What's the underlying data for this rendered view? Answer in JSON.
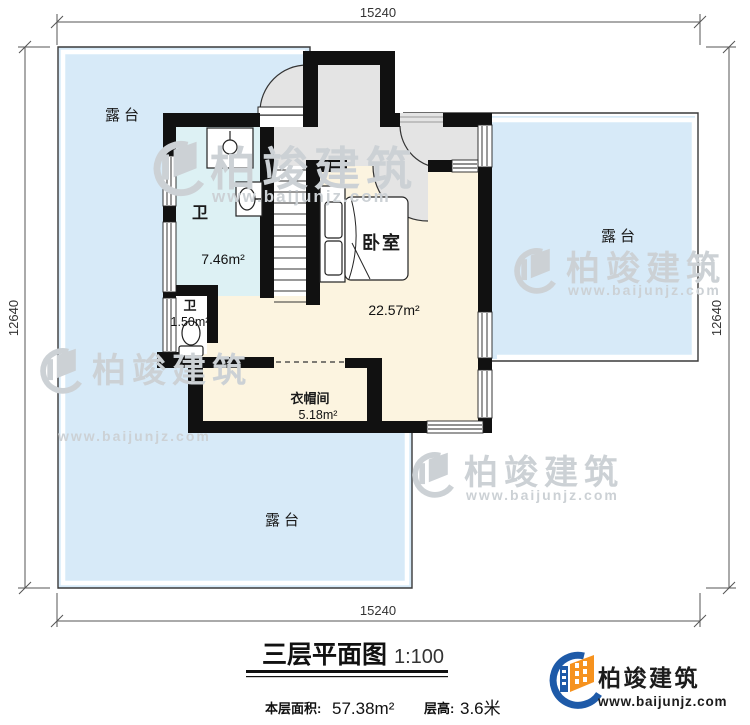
{
  "plan": {
    "dim_top": "15240",
    "dim_bottom": "15240",
    "dim_left": "12640",
    "dim_right": "12640",
    "rooms": {
      "terrace_top": "露台",
      "terrace_right": "露台",
      "terrace_bottom": "露台",
      "bathroom_label": "卫",
      "bathroom_area": "7.46m²",
      "wc_label": "卫",
      "wc_area": "1.50m²",
      "bedroom_label": "卧室",
      "bedroom_area": "22.57m²",
      "cloakroom_label": "衣帽间",
      "cloakroom_area": "5.18m²"
    }
  },
  "title_block": {
    "title": "三层平面图",
    "scale": "1:100",
    "area_label": "本层面积:",
    "area_value": "57.38m²",
    "height_label": "层高:",
    "height_value": "3.6米"
  },
  "branding": {
    "company": "柏竣建筑",
    "website": "www.baijunjz.com",
    "brand_blue": "#1e5aa8",
    "brand_orange": "#f6921e"
  },
  "watermark": {
    "company": "柏竣建筑",
    "website": "www.baijunjz.com"
  }
}
